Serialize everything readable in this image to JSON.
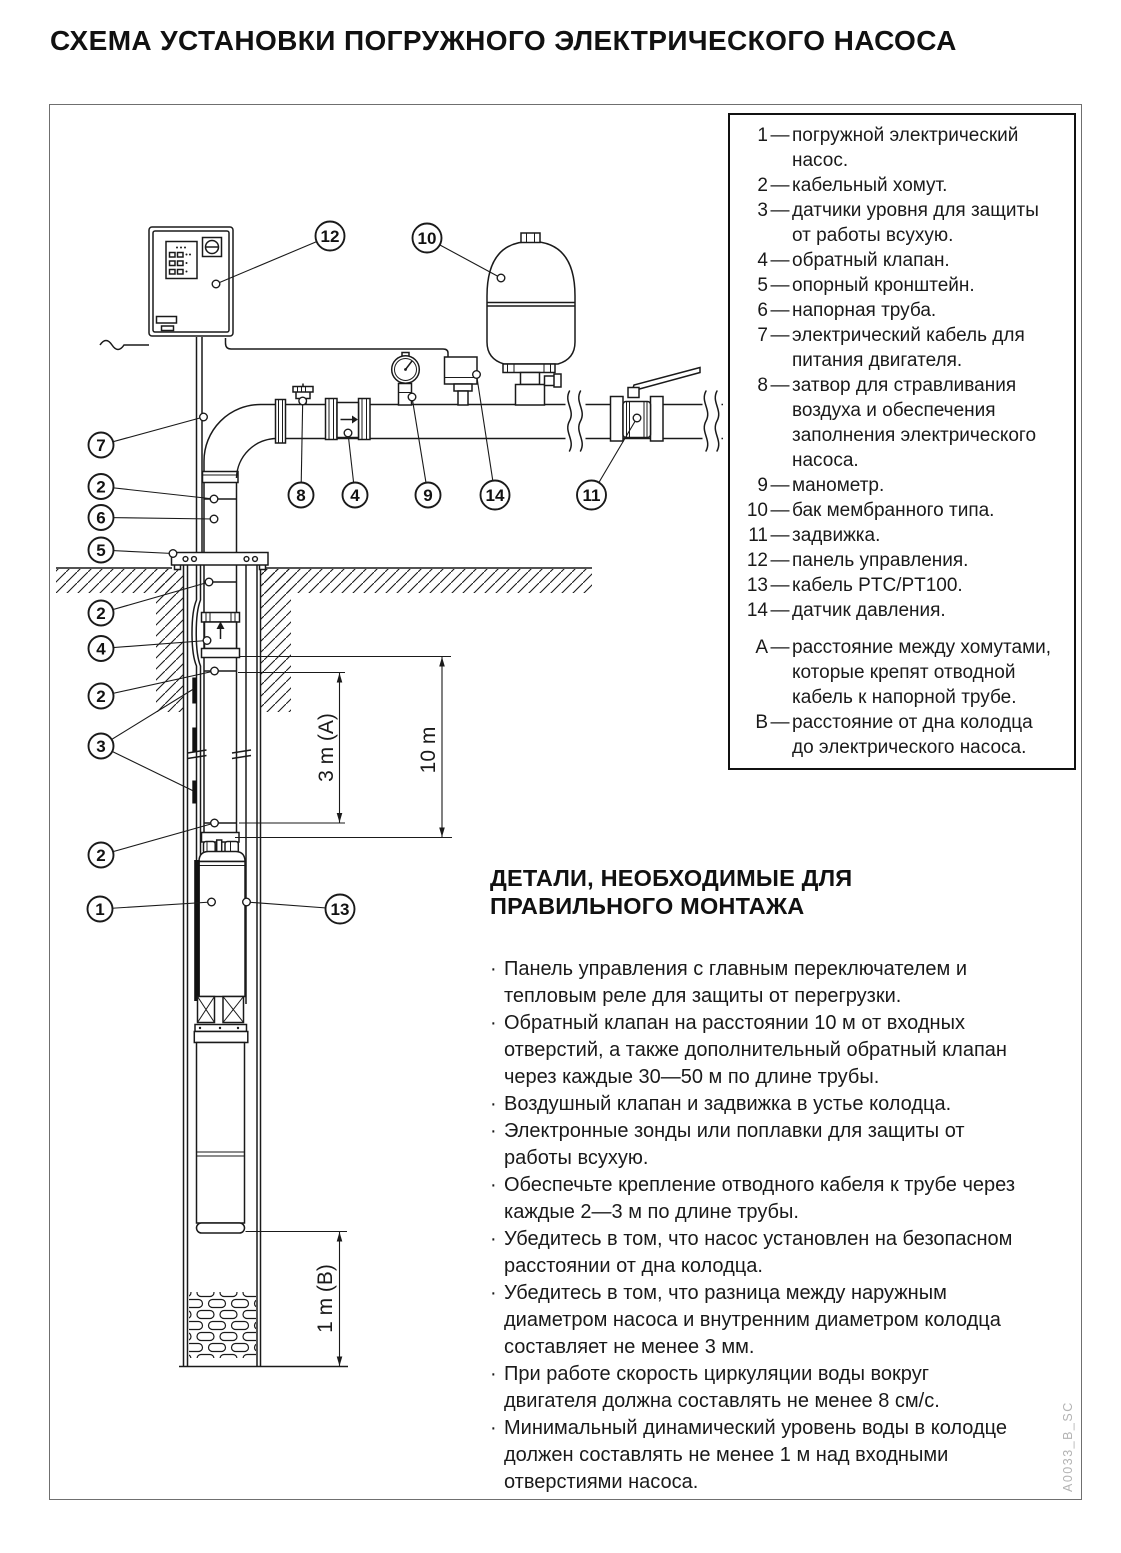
{
  "title": "СХЕМА УСТАНОВКИ ПОГРУЖНОГО ЭЛЕКТРИЧЕСКОГО НАСОСА",
  "colors": {
    "ink": "#1a1a1a",
    "watermark_gray": "#b3b3b3"
  },
  "legend": {
    "dash": "—",
    "items": [
      {
        "n": "1",
        "text": "погружной электрический\nнасос."
      },
      {
        "n": "2",
        "text": "кабельный хомут."
      },
      {
        "n": "3",
        "text": "датчики уровня для защиты\nот работы всухую."
      },
      {
        "n": "4",
        "text": "обратный клапан."
      },
      {
        "n": "5",
        "text": "опорный кронштейн."
      },
      {
        "n": "6",
        "text": "напорная труба."
      },
      {
        "n": "7",
        "text": "электрический кабель для\nпитания двигателя."
      },
      {
        "n": "8",
        "text": "затвор для стравливания\nвоздуха и обеспечения\nзаполнения электрического\nнасоса."
      },
      {
        "n": "9",
        "text": "манометр."
      },
      {
        "n": "10",
        "text": "бак мембранного типа."
      },
      {
        "n": "11",
        "text": "задвижка."
      },
      {
        "n": "12",
        "text": "панель управления."
      },
      {
        "n": "13",
        "text": "кабель PTC/PT100."
      },
      {
        "n": "14",
        "text": "датчик давления."
      }
    ],
    "notes": [
      {
        "n": "А",
        "text": "расстояние между хомутами,\nкоторые крепят отводной\nкабель к напорной трубе."
      },
      {
        "n": "В",
        "text": "расстояние от дна колодца\nдо электрического насоса."
      }
    ]
  },
  "details": {
    "heading": "ДЕТАЛИ, НЕОБХОДИМЫЕ ДЛЯ\nПРАВИЛЬНОГО МОНТАЖА",
    "bullet_char": "·",
    "bullets": [
      {
        "text": "Панель управления с главным переключателем и\nтепловым реле для защиты от перегрузки."
      },
      {
        "text": "Обратный клапан на расстоянии 10 м от входных\nотверстий, а также дополнительный обратный клапан\nчерез каждые 30—50 м по длине трубы."
      },
      {
        "text": "Воздушный клапан и задвижка в устье колодца."
      },
      {
        "text": "Электронные зонды или поплавки для защиты от\nработы всухую."
      },
      {
        "text": "Обеспечьте крепление отводного кабеля к трубе через\nкаждые 2—3 м по длине трубы."
      },
      {
        "text": "Убедитесь в том, что насос установлен на безопасном\nрасстоянии от дна колодца."
      },
      {
        "text": "Убедитесь в том, что разница между наружным\nдиаметром насоса и внутренним диаметром колодца\nсоставляет не менее 3 мм."
      },
      {
        "text": "При работе скорость циркуляции воды вокруг\nдвигателя должна составлять не менее 8 см/с."
      },
      {
        "text": "Минимальный динамический уровень воды в колодце\nдолжен составлять не менее 1 м над входными\nотверстиями насоса."
      }
    ]
  },
  "diagram": {
    "callouts": [
      "12",
      "10",
      "7",
      "2",
      "6",
      "5",
      "2",
      "4",
      "2",
      "3",
      "2",
      "1",
      "13",
      "8",
      "4",
      "9",
      "14",
      "11"
    ],
    "dim_a": "3 m (A)",
    "dim_10": "10 m",
    "dim_b": "1 m (B)",
    "doc_code": "A0033_B_SC"
  }
}
